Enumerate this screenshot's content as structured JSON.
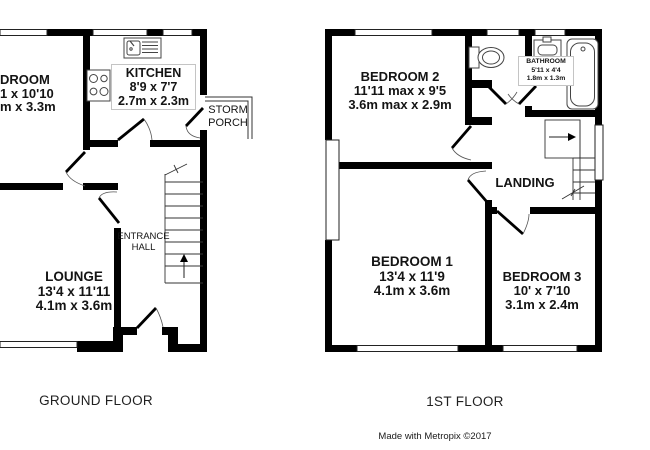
{
  "ground_floor": {
    "floor_label": "GROUND FLOOR",
    "rooms": {
      "clipped_room": {
        "name_fragment": "DROOM",
        "dims_ft_fragment": "1 x 10'10",
        "dims_m_fragment": "m x 3.3m"
      },
      "kitchen": {
        "name": "KITCHEN",
        "dims_ft": "8'9 x 7'7",
        "dims_m": "2.7m x 2.3m"
      },
      "storm_porch": {
        "line1": "STORM",
        "line2": "PORCH"
      },
      "lounge": {
        "name": "LOUNGE",
        "dims_ft": "13'4 x 11'11",
        "dims_m": "4.1m x 3.6m"
      },
      "entrance_hall": {
        "line1": "ENTRANCE",
        "line2": "HALL"
      }
    }
  },
  "first_floor": {
    "floor_label": "1ST FLOOR",
    "rooms": {
      "bedroom2": {
        "name": "BEDROOM 2",
        "dims_ft": "11'11 max x 9'5",
        "dims_m": "3.6m max x 2.9m"
      },
      "bathroom": {
        "name": "BATHROOM",
        "dims_ft": "5'11 x 4'4",
        "dims_m": "1.8m x 1.3m"
      },
      "landing": {
        "name": "LANDING"
      },
      "bedroom1": {
        "name": "BEDROOM 1",
        "dims_ft": "13'4 x 11'9",
        "dims_m": "4.1m x 3.6m"
      },
      "bedroom3": {
        "name": "BEDROOM 3",
        "dims_ft": "10' x 7'10",
        "dims_m": "3.1m x 2.4m"
      }
    }
  },
  "footer": {
    "credit": "Made with Metropix ©2017"
  },
  "colors": {
    "wall": "#000000",
    "background": "#ffffff",
    "thin_line": "#333333"
  }
}
